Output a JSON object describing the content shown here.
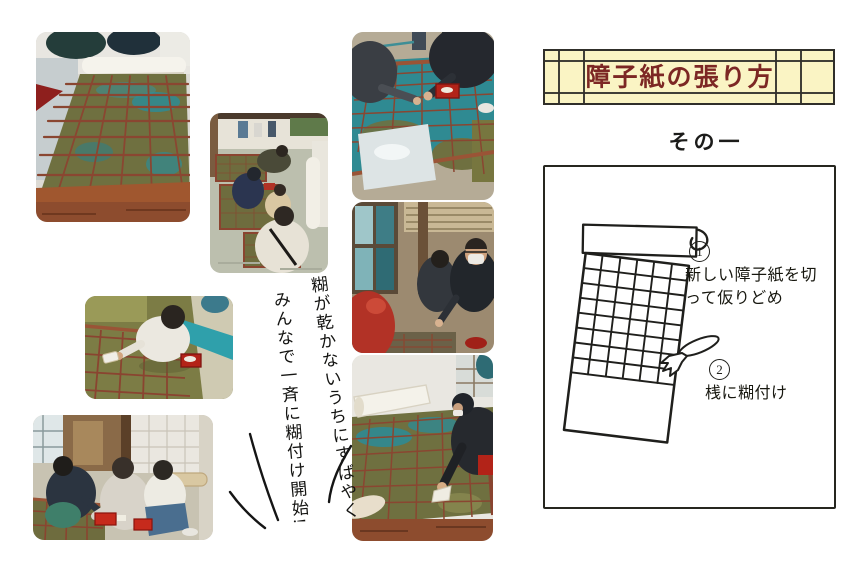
{
  "theme": {
    "paper": "#ffffff",
    "ink": "#1c1c1a",
    "banner_bg": "#faf4c4",
    "banner_line": "#302f2a",
    "title_color": "#7c2724"
  },
  "header": {
    "title": "障子紙の張り方",
    "subtitle": "その一"
  },
  "caption": {
    "line1": "糊が乾かないうちにすばやく",
    "line2": "みんなで一斉に糊付け開始!"
  },
  "diagram": {
    "steps": [
      {
        "num": "1",
        "line1": "新しい障子紙を切",
        "line2": "って仮りどめ"
      },
      {
        "num": "2",
        "line1": "桟に糊付け",
        "line2": ""
      }
    ]
  },
  "photos": [
    {
      "desc": "桟の上に障子紙を広げた様子のクローズアップ"
    },
    {
      "desc": "部屋でみんながしゃがんで障子を張る様子"
    },
    {
      "desc": "桟の上で紙を押さえる人たち"
    },
    {
      "desc": "窓辺で糊の準備をする人たち"
    },
    {
      "desc": "桟に刷毛で糊を塗る人"
    },
    {
      "desc": "刷毛で糊付けする人のアップ"
    },
    {
      "desc": "赤い糊入れを持って一斉に糊付けする人たち"
    }
  ]
}
